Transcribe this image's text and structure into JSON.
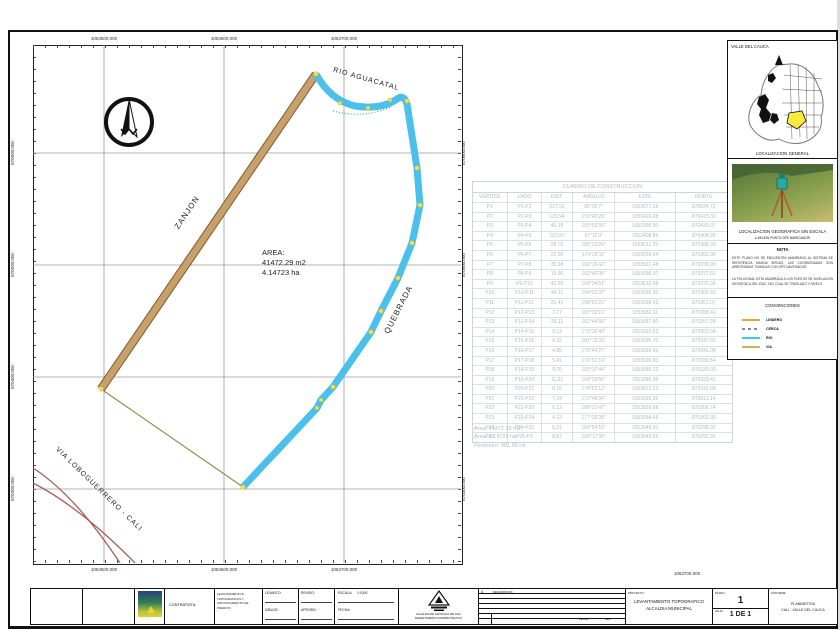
{
  "map": {
    "x_labels": [
      "1053500.000",
      "1053600.000",
      "1053700.000"
    ],
    "y_labels": [
      "870600.000",
      "870500.000",
      "870400.000",
      "870300.000"
    ],
    "stray_label": "1053700.000",
    "labels": {
      "rio": "RIO AGUACATAL",
      "zanjon": "ZANJON",
      "quebrada": "QUEBRADA",
      "via": "VIA LOBOGUERRERO - CALI"
    },
    "area_block": {
      "title": "AREA:",
      "line1": "41472.29 m2",
      "line2": "4.14723 ha"
    },
    "colors": {
      "rio": "#4ac0ea",
      "zanjon": "#c8a06a",
      "road": "#a55c5c",
      "vertex": "#f5e050"
    }
  },
  "table": {
    "title": "CUADRO DE CONSTRUCCION",
    "columns": [
      "VERTICE",
      "LADO",
      "DIST.",
      "ANGULO",
      "ESTE",
      "NORTE"
    ],
    "rows": [
      [
        "P1",
        "P1-P2",
        "227.52",
        "86°30'7\"",
        "1053577.18",
        "870634.72"
      ],
      [
        "P2",
        "P2-P3",
        "120.94",
        "170°43'25\"",
        "1053416.08",
        "870473.30"
      ],
      [
        "P3",
        "P3-P4",
        "46.18",
        "165°52'55\"",
        "1053399.90",
        "870430.07"
      ],
      [
        "P4",
        "P4-P5",
        "103.87",
        "97°11'9\"",
        "1053408.84",
        "870404.95"
      ],
      [
        "P5",
        "P5-P6",
        "28.76",
        "185°33'20\"",
        "1053511.29",
        "870388.03"
      ],
      [
        "P6",
        "P6-P7",
        "22.30",
        "174°28'11\"",
        "1053539.64",
        "870383.36"
      ],
      [
        "P7",
        "P7-P8",
        "35.98",
        "166°15'42\"",
        "1053561.48",
        "870378.90"
      ],
      [
        "P8",
        "P8-P9",
        "15.90",
        "192°40'36\"",
        "1053596.97",
        "870372.81"
      ],
      [
        "P9",
        "P9-P10",
        "42.92",
        "168°34'51\"",
        "1053612.68",
        "870370.34"
      ],
      [
        "P10",
        "P10-P11",
        "44.11",
        "154°23'37\"",
        "1053655.30",
        "870365.52"
      ],
      [
        "P11",
        "P11-P12",
        "21.41",
        "198°51'22\"",
        "1053668.93",
        "870361.07"
      ],
      [
        "P12",
        "P12-P13",
        "7.77",
        "187°32'15\"",
        "1053680.11",
        "870358.41"
      ],
      [
        "P13",
        "P13-P14",
        "25.11",
        "162°44'58\"",
        "1053687.80",
        "870357.29"
      ],
      [
        "P14",
        "P14-P15",
        "9.13",
        "173°26'40\"",
        "1053692.63",
        "870353.64"
      ],
      [
        "P15",
        "P15-P16",
        "4.32",
        "181°15'33\"",
        "1053695.70",
        "870347.55"
      ],
      [
        "P16",
        "P16-P17",
        "4.85",
        "179°42'27\"",
        "1053693.00",
        "870341.08"
      ],
      [
        "P17",
        "P17-P18",
        "5.41",
        "176°51'19\"",
        "1053690.83",
        "870336.54"
      ],
      [
        "P18",
        "P18-P19",
        "9.76",
        "183°37'44\"",
        "1053686.22",
        "870330.03"
      ],
      [
        "P19",
        "P19-P20",
        "11.31",
        "168°29'56\"",
        "1053680.96",
        "870323.41"
      ],
      [
        "P20",
        "P20-P21",
        "8.15",
        "174°53'12\"",
        "1053672.23",
        "870316.68"
      ],
      [
        "P21",
        "P21-P22",
        "7.24",
        "172°48'34\"",
        "1053665.36",
        "870311.14"
      ],
      [
        "P22",
        "P22-P23",
        "5.12",
        "186°21'47\"",
        "1053659.58",
        "870306.74"
      ],
      [
        "P23",
        "P23-P24",
        "4.23",
        "177°39'28\"",
        "1053654.69",
        "870302.35"
      ],
      [
        "P24",
        "P24-P25",
        "5.21",
        "169°54'16\"",
        "1053649.90",
        "870298.02"
      ],
      [
        "P25",
        "P25-P1",
        "8.87",
        "168°17'30\"",
        "1053643.09",
        "870292.26"
      ]
    ],
    "summary": [
      "Area: 41472.29 m2",
      "Area: 4.14723 ha",
      "Perimetro: 981.90 mt"
    ]
  },
  "sidebar": {
    "region_label": "VALLE DEL CAUCA",
    "general_caption": "LOCALIZACION GENERAL",
    "photo_caption": "LOCALIZACION GEOGRAFICA SIN ESCALA",
    "photo_subcaption": "● MOJON PUNTO GPS NAVEGADOR",
    "nota_title": "NOTA",
    "nota_p1": "ESTE PLANO NO SE ENCUENTRA AMARRADO AL SISTEMA DE REFERENCIA MAGNA SIRGAS, LAS COORDENADAS SON ARBITRARIAS TOMADAS CON GPS NAVEGADOR.",
    "nota_p2": "LA POLIGONAL ESTA AMARRADA A LOS PUNTOS DE NIVELACION GEODESICA DEL IGAC, DEL CUAL SE TRASLADO Y NIVELO.",
    "conv_title": "CONVENCIONES",
    "legend": [
      {
        "label": "LINDERO",
        "color": "#e8a33d",
        "dash": false
      },
      {
        "label": "CERCA",
        "color": "#8a8a8a",
        "dash": true
      },
      {
        "label": "RIO",
        "color": "#4ac0ea",
        "dash": false
      },
      {
        "label": "VIA",
        "color": "#c8b560",
        "dash": false
      }
    ],
    "highlight_color": "#f7ec3e"
  },
  "titleblock": {
    "contratista_label": "CONTRATISTA:",
    "firm": [
      "LEVANTAMIENTOS",
      "TOPOGRAFICOS Y",
      "AMOJONAMIENTO DE PREDIOS"
    ],
    "f_levanto": "LEVANTO:",
    "f_dibujo": "DIBUJO:",
    "f_reviso": "REVISO:",
    "f_aprobo": "APROBO:",
    "f_escala": "ESCALA:",
    "f_escala_val": "1:1000",
    "f_fecha": "FECHA:",
    "seal_caption_1": "ALCALDIA DE SANTIAGO DE CALI",
    "seal_caption_2": "DEPARTAMENTO ADMINISTRATIVO",
    "rev_letter": "A",
    "rev_desc": "DESCRIPCION",
    "rev_fecha": "FECHA",
    "rev_rev": "REV",
    "proyecto_label": "PROYECTO:",
    "project_1": "LEVANTAMIENTO TOPOGRAFICO",
    "project_2": "ALCALDIA MUNICIPAL",
    "plano_label": "PLANO:",
    "plano_number": "1",
    "hoja_label": "HOJA:",
    "hoja_value": "1 DE 1",
    "contiene_label": "CONTIENE:",
    "contiene_1": "PLANIMETRIA",
    "contiene_2": "CALI - VALLE DEL CAUCA"
  }
}
